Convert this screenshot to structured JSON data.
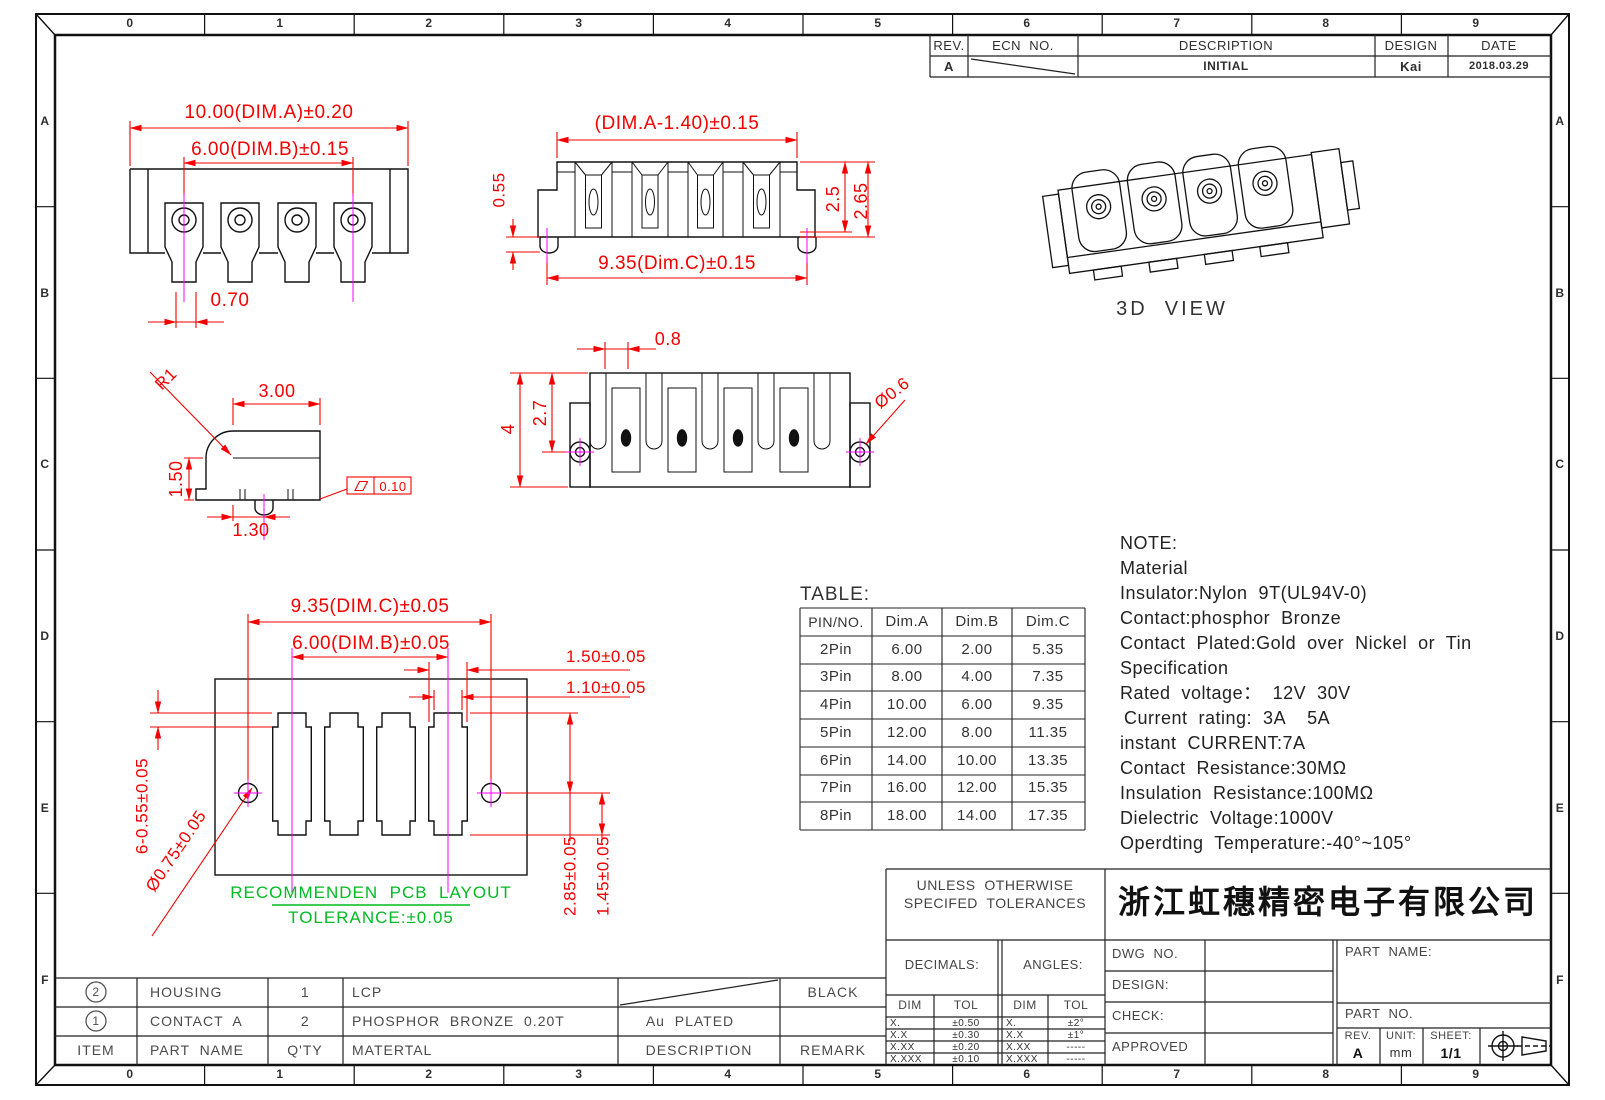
{
  "border": {
    "columns": [
      "0",
      "1",
      "2",
      "3",
      "4",
      "5",
      "6",
      "7",
      "8",
      "9"
    ],
    "rows": [
      "A",
      "B",
      "C",
      "D",
      "E",
      "F"
    ]
  },
  "revision": {
    "headers": {
      "rev": "REV.",
      "ecn": "ECN  NO.",
      "description": "DESCRIPTION",
      "design": "DESIGN",
      "date": "DATE"
    },
    "entry": {
      "rev": "A",
      "description": "INITIAL",
      "design": "Kai",
      "date": "2018.03.29"
    }
  },
  "front_view": {
    "dim_a": "10.00(DIM.A)±0.20",
    "dim_b": "6.00(DIM.B)±0.15",
    "slot_width": "0.70"
  },
  "side_view": {
    "dim_top": "(DIM.A-1.40)±0.15",
    "pin_height": "0.55",
    "height_inner": "2.5",
    "height_outer": "2.65",
    "dim_bottom": "9.35(Dim.C)±0.15"
  },
  "iso_view": {
    "label": "3D  VIEW"
  },
  "detail_view": {
    "radius": "R1",
    "width": "3.00",
    "height": "1.50",
    "pin_offset": "1.30",
    "flatness": "0.10"
  },
  "top_view": {
    "slot": "0.8",
    "depth_inner": "2.7",
    "depth_outer": "4",
    "hole_dia": "Ø0.6"
  },
  "pcb_view": {
    "dim_c": "9.35(DIM.C)±0.05",
    "dim_b": "6.00(DIM.B)±0.05",
    "pad_w": "1.50±0.05",
    "pad_w2": "1.10±0.05",
    "pad_h": "6-0.55±0.05",
    "hole_dia": "Ø0.75±0.05",
    "dist1": "2.85±0.05",
    "dist2": "1.45±0.05",
    "caption1": "RECOMMENDEN  PCB  LAYOUT",
    "caption2": "TOLERANCE:±0.05"
  },
  "pin_table": {
    "title": "TABLE:",
    "headers": [
      "PIN/NO.",
      "Dim.A",
      "Dim.B",
      "Dim.C"
    ],
    "rows": [
      [
        "2Pin",
        "6.00",
        "2.00",
        "5.35"
      ],
      [
        "3Pin",
        "8.00",
        "4.00",
        "7.35"
      ],
      [
        "4Pin",
        "10.00",
        "6.00",
        "9.35"
      ],
      [
        "5Pin",
        "12.00",
        "8.00",
        "11.35"
      ],
      [
        "6Pin",
        "14.00",
        "10.00",
        "13.35"
      ],
      [
        "7Pin",
        "16.00",
        "12.00",
        "15.35"
      ],
      [
        "8Pin",
        "18.00",
        "14.00",
        "17.35"
      ]
    ]
  },
  "note": {
    "lines": [
      "NOTE:",
      "Material",
      "Insulator:Nylon  9T(UL94V-0)",
      "Contact:phosphor  Bronze",
      "Contact  Plated:Gold  over  Nickel  or  Tin",
      "Specification",
      "Rated  voltage：  12V  30V",
      "Current  rating:  3A    5A",
      "instant  CURRENT:7A",
      "Contact  Resistance:30MΩ",
      "Insulation  Resistance:100MΩ",
      "Dielectric  Voltage:1000V",
      "Operdting  Temperature:-40°~105°"
    ]
  },
  "bom": {
    "headers": [
      "ITEM",
      "PART  NAME",
      "Q'TY",
      "MATERTAL",
      "DESCRIPTION",
      "REMARK"
    ],
    "rows": [
      {
        "item": "2",
        "part_name": "HOUSING",
        "qty": "1",
        "material": "LCP",
        "description": "",
        "remark": "BLACK"
      },
      {
        "item": "1",
        "part_name": "CONTACT  A",
        "qty": "2",
        "material": "PHOSPHOR  BRONZE  0.20T",
        "description": "Au  PLATED",
        "remark": ""
      }
    ]
  },
  "title_block": {
    "tolerances_label1": "UNLESS  OTHERWISE",
    "tolerances_label2": "SPECIFED  TOLERANCES",
    "company": "浙江虹穗精密电子有限公司",
    "decimals_label": "DECIMALS:",
    "angles_label": "ANGLES:",
    "dim_col": "DIM",
    "tol_col": "TOL",
    "decimals_rows": [
      [
        "X.",
        "±0.50"
      ],
      [
        "X.X",
        "±0.30"
      ],
      [
        "X.XX",
        "±0.20"
      ],
      [
        "X.XXX",
        "±0.10"
      ]
    ],
    "angles_rows": [
      [
        "X.",
        "±2°"
      ],
      [
        "X.X",
        "±1°"
      ],
      [
        "X.XX",
        "-----"
      ],
      [
        "X.XXX",
        "-----"
      ]
    ],
    "dwg_no": "DWG  NO.",
    "design": "DESIGN:",
    "check": "CHECK:",
    "approved": "APPROVED",
    "part_name": "PART  NAME:",
    "part_no": "PART  NO.",
    "rev_label": "REV.",
    "rev_value": "A",
    "unit_label": "UNIT:",
    "unit_value": "mm",
    "sheet_label": "SHEET:",
    "sheet_value": "1/1"
  }
}
